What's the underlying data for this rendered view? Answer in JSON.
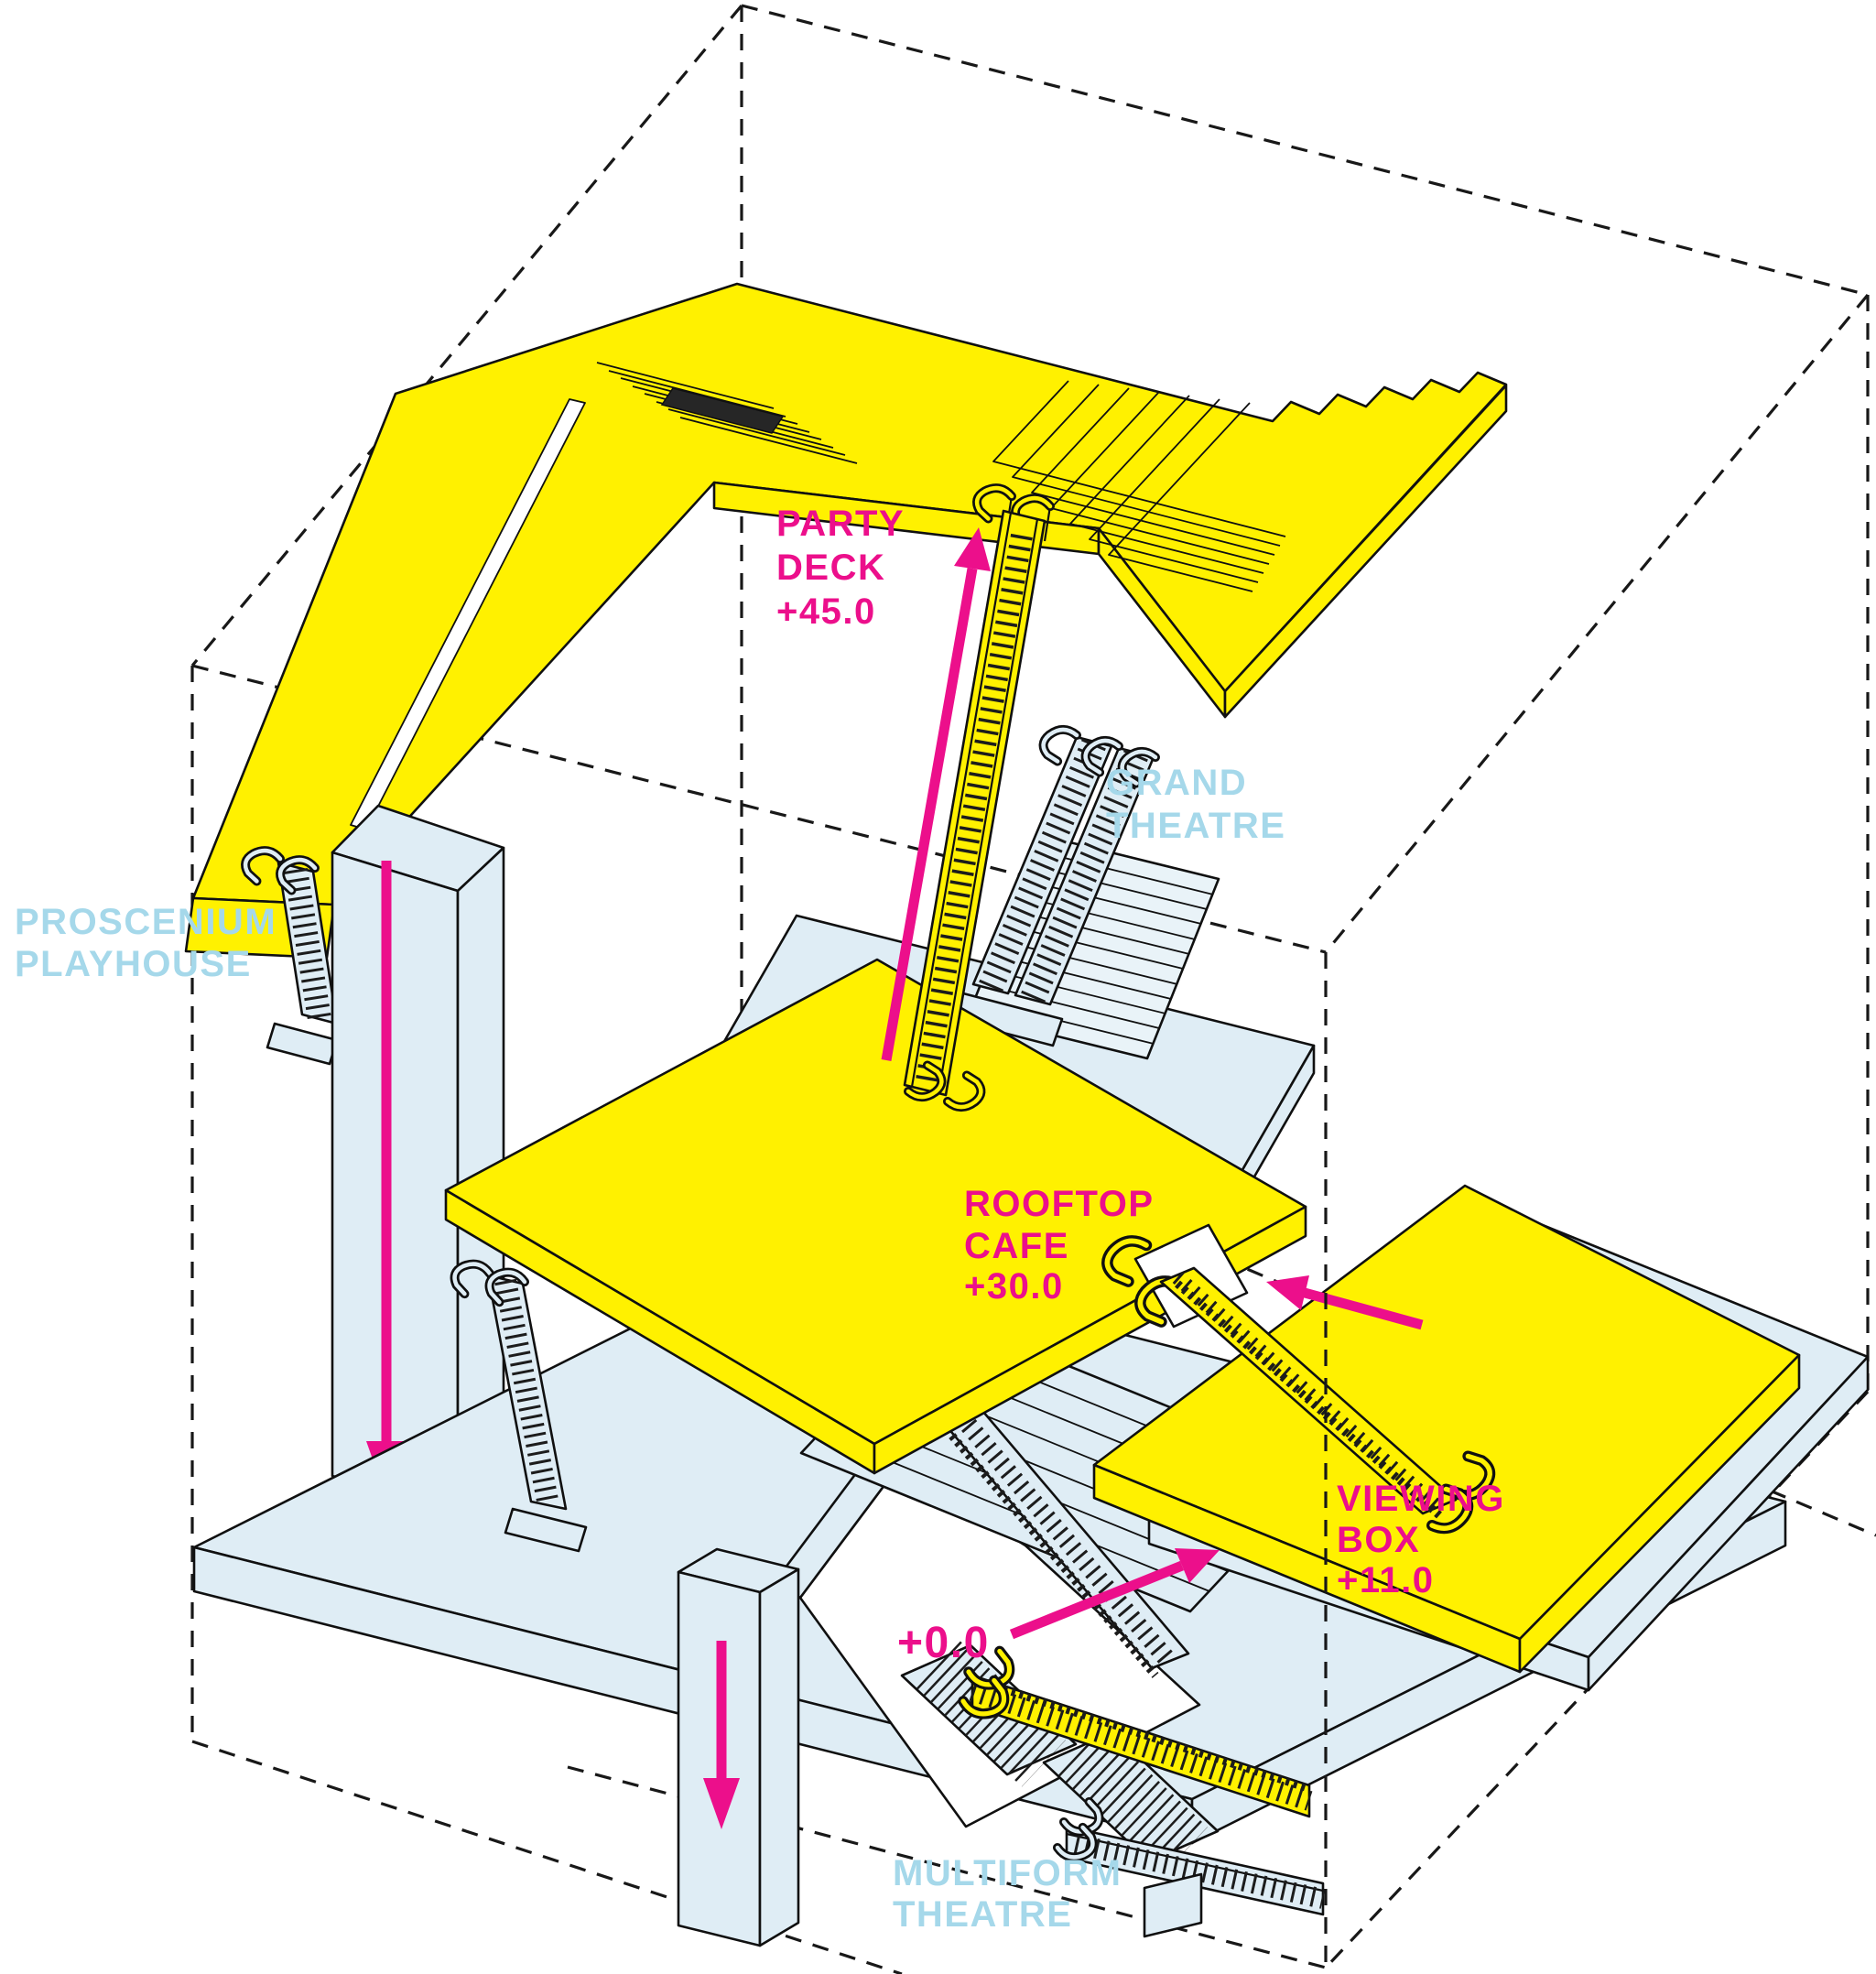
{
  "labels": {
    "party_deck": {
      "l1": "PARTY",
      "l2": "DECK",
      "level": "+45.0"
    },
    "grand_theatre": {
      "l1": "GRAND",
      "l2": "THEATRE"
    },
    "proscenium_playhouse": {
      "l1": "PROSCENIUM",
      "l2": "PLAYHOUSE"
    },
    "rooftop_cafe": {
      "l1": "ROOFTOP",
      "l2": "CAFE",
      "level": "+30.0"
    },
    "viewing_box": {
      "l1": "VIEWING",
      "l2": "BOX",
      "level": "+11.0"
    },
    "street_level": {
      "level": "+0.0"
    },
    "multiform_theatre": {
      "l1": "MULTIFORM",
      "l2": "THEATRE"
    }
  },
  "arrows": [
    {
      "name": "up-to-party-deck",
      "direction": "up"
    },
    {
      "name": "down-proscenium-tower",
      "direction": "down"
    },
    {
      "name": "down-to-multiform",
      "direction": "down"
    },
    {
      "name": "up-to-viewing-box",
      "direction": "up-right"
    },
    {
      "name": "return-to-rooftop-cafe",
      "direction": "left"
    }
  ],
  "colors": {
    "highlight": "#FFF100",
    "volume": "#DFEDF5",
    "volume_light": "#E9F3F8",
    "label_blue": "#A5D8EA",
    "accent": "#EC0F8B",
    "outline": "#101010",
    "hatch_dark": "#262626"
  }
}
